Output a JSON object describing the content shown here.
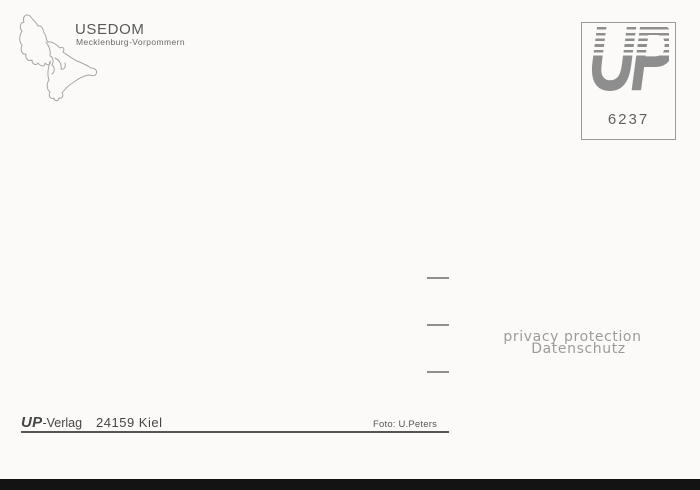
{
  "postcard": {
    "map_label": {
      "title": "USEDOM",
      "subtitle": "Mecklenburg-Vorpommern"
    },
    "stamp_box": {
      "logo_text": "UP",
      "number": "6237"
    },
    "watermark": {
      "line1": "privacy protection",
      "line2": "Datenschutz"
    },
    "imprint": {
      "brand": "UP",
      "brand_suffix": "-Verlag",
      "postal_city": "24159 Kiel"
    },
    "photo_credit": "Foto: U.Peters",
    "colors": {
      "background": "#fbfaf8",
      "title_ink": "#5a5a5a",
      "logo_gray": "#8e8e8e",
      "watermark_gray": "#9c9c9c",
      "dash_gray": "#8f8f8f",
      "imprint_ink": "#464646",
      "bottom_bar": "#131313"
    }
  }
}
